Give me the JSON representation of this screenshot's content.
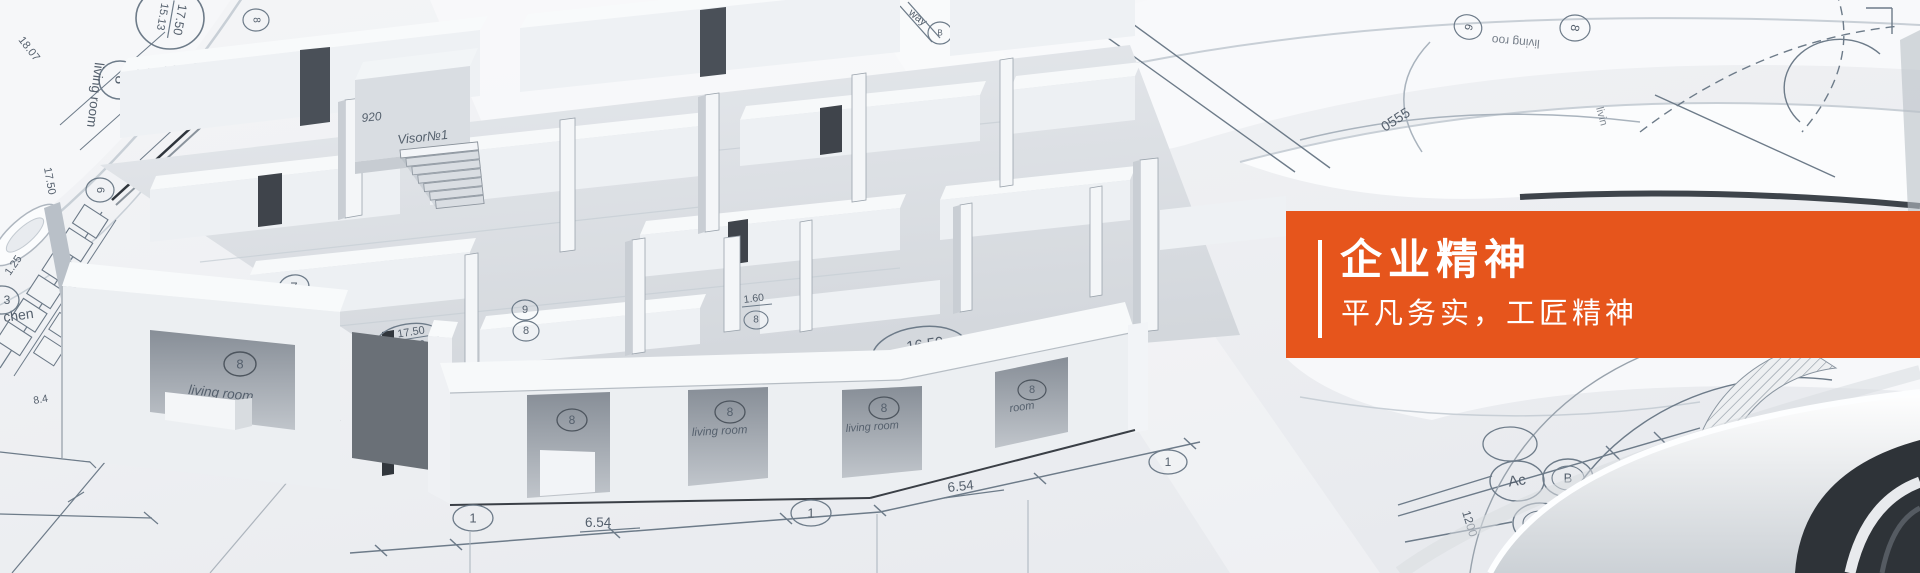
{
  "page": {
    "title": "企业精神",
    "subtitle": "平凡务实，工匠精神"
  },
  "colors": {
    "accent_orange": "#E6551C",
    "text_white": "#FFFFFF",
    "paper": "#EFF1F4",
    "blueprint_line": "#7C8B9B",
    "model_wall": "#F2F4F6",
    "dark_opening": "#3F444B"
  },
  "blueprint": {
    "roll_top_left": {
      "dim_18_07": "18.07",
      "area_prefix": "1",
      "area_top": "17.50",
      "area_bottom": "15.13",
      "marker_8": "8",
      "room_label": "living room",
      "dim_17_50": "17.50",
      "marker_8_small": "8",
      "marker_6": "6"
    },
    "plan_left": {
      "dim_1_25": "1.25",
      "room_partial": "chen",
      "dim_8_4": "8.4",
      "marker_3": "3"
    },
    "plan_top_center": {
      "note_way": "way",
      "marker_b": "B"
    },
    "rolls_top_right": {
      "marker_6": "6",
      "room_label_partial": "living roo",
      "marker_8": "8",
      "room_label_partial_2": "livin",
      "code_0555": "0555"
    },
    "plan_bottom_right": {
      "marker_ac": "Ac",
      "marker_b": "B",
      "dim_1200": "1200",
      "note_n4": "N4"
    },
    "dimensions_front": {
      "dim_6_54": "6.54",
      "marker_1": "1"
    }
  },
  "model": {
    "window_marker": "8",
    "window_label": "living room",
    "window_label_short": "room",
    "marker_7": "7",
    "marker_9": "9",
    "marker_8": "8",
    "area_label_1": {
      "prefix": "1",
      "top": "17.50",
      "bottom": "15.13"
    },
    "area_label_2": {
      "prefix": "1",
      "top": "16.59",
      "bottom": "15.32"
    },
    "shaft_code": "920",
    "shaft_label": "Visor№1",
    "dim_1_60": "1.60"
  }
}
